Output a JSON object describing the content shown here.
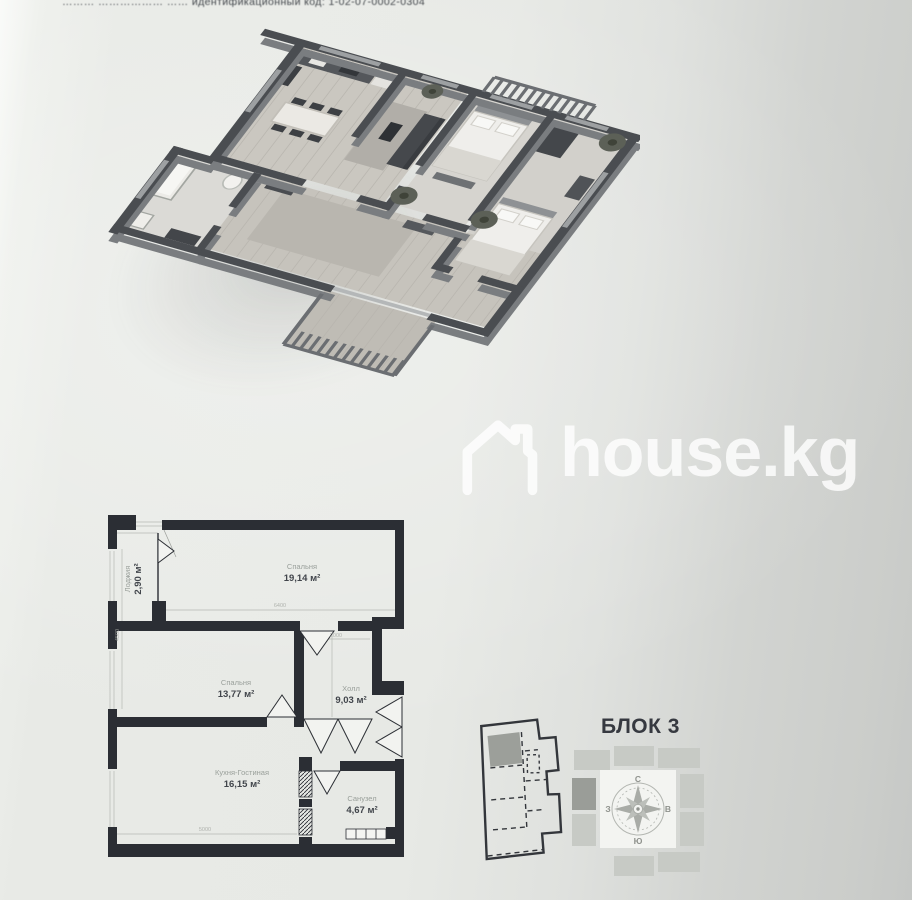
{
  "photo": {
    "top_caption": "………  ………………  ……  идентификационный код: 1-02-07-0002-0304"
  },
  "watermark": {
    "brand": "house.kg",
    "icon": "house-outline"
  },
  "plan": {
    "rooms": [
      {
        "name": "Спальня",
        "area": "19,14 м²"
      },
      {
        "name": "Лоджия",
        "area": "2,90 м²"
      },
      {
        "name": "Спальня",
        "area": "13,77 м²"
      },
      {
        "name": "Холл",
        "area": "9,03 м²"
      },
      {
        "name": "Кухня-Гостиная",
        "area": "16,15 м²"
      },
      {
        "name": "Санузел",
        "area": "4,67 м²"
      }
    ],
    "dims": {
      "top": "6400",
      "left": "4500",
      "hall": "2000",
      "bottom": "5000"
    }
  },
  "block": {
    "title": "БЛОК 3"
  },
  "compass": {
    "n": "С",
    "s": "Ю",
    "w": "З",
    "e": "В"
  },
  "colors": {
    "paper": "#e8eae6",
    "ink": "#2b2e34",
    "plan_gray": "#9a9d98",
    "watermark": "rgba(255,255,255,0.8)"
  }
}
